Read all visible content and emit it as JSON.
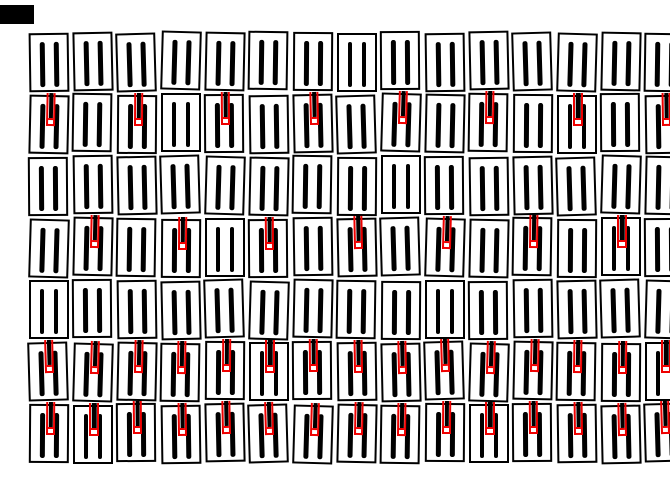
{
  "canvas": {
    "width_px": 670,
    "height_px": 503,
    "background_color": "#ffffff"
  },
  "palette": {
    "outline_color": "#000000",
    "bar_color": "#000000",
    "marker_color": "#ee0000",
    "tile_fill_color": "#ffffff"
  },
  "corner_mark": {
    "present": true,
    "color": "#000000"
  },
  "grid": {
    "rows": 7,
    "cols": 15,
    "bars_per_tile": 2,
    "marker_name": "red-pin-marker",
    "marker_rows": [
      {
        "row": 1,
        "marked_cols": []
      },
      {
        "row": 2,
        "marked_cols": [
          1,
          3,
          5,
          7,
          9,
          11,
          13,
          15
        ]
      },
      {
        "row": 3,
        "marked_cols": []
      },
      {
        "row": 4,
        "marked_cols": [
          2,
          4,
          6,
          8,
          10,
          12,
          14
        ]
      },
      {
        "row": 5,
        "marked_cols": []
      },
      {
        "row": 6,
        "marked_cols": [
          1,
          2,
          3,
          4,
          5,
          6,
          7,
          8,
          9,
          10,
          11,
          12,
          13,
          14,
          15
        ]
      },
      {
        "row": 7,
        "marked_cols": [
          1,
          2,
          3,
          4,
          5,
          6,
          7,
          8,
          9,
          10,
          11,
          12,
          13,
          14,
          15
        ]
      }
    ]
  }
}
